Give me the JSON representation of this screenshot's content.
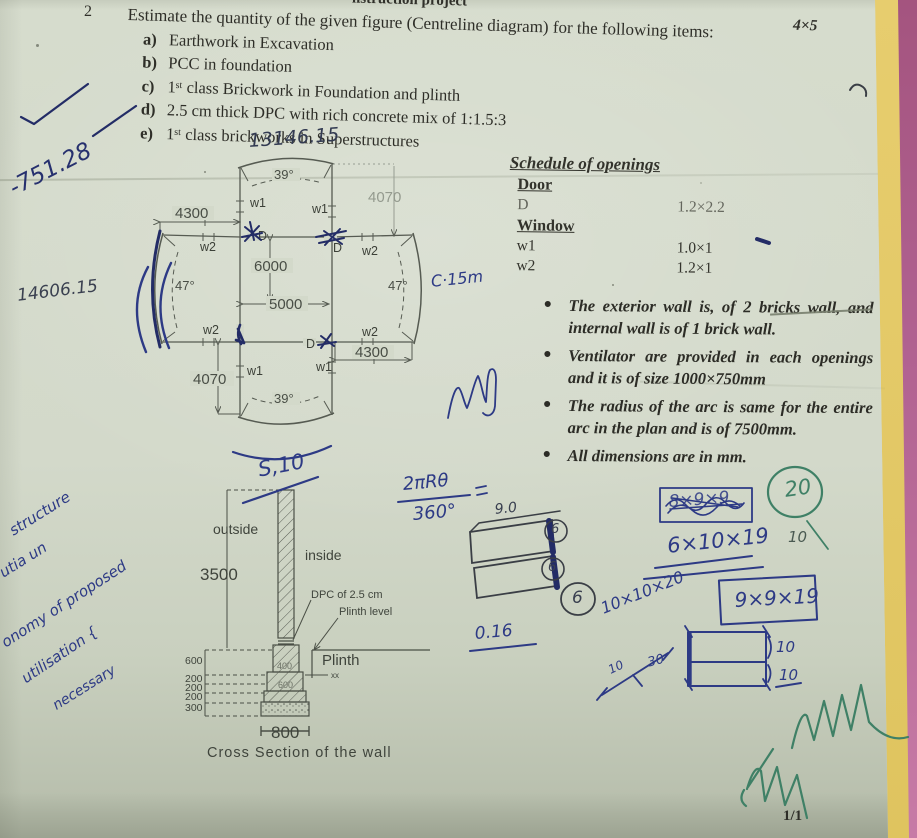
{
  "page": {
    "number_label": "2",
    "top_scrap": "nstruction project",
    "question": "Estimate the quantity of the given figure (Centreline diagram) for the following items:",
    "marks": "4×5",
    "items": [
      {
        "label": "a)",
        "text": "Earthwork in Excavation"
      },
      {
        "label": "b)",
        "text": "PCC in foundation"
      },
      {
        "label": "c)",
        "text": "1ˢᵗ class Brickwork in Foundation and plinth"
      },
      {
        "label": "d)",
        "text": "2.5 cm thick DPC with rich concrete mix of 1:1.5:3"
      },
      {
        "label": "e)",
        "text": "1ˢᵗ class brickworks in Superstructures"
      }
    ],
    "footer": "1/1"
  },
  "schedule": {
    "title": "Schedule of openings",
    "door_heading": "Door",
    "door_row": {
      "name": "D",
      "size": "1.2×2.2"
    },
    "window_heading": "Window",
    "window_rows": [
      {
        "name": "w1",
        "size": "1.0×1"
      },
      {
        "name": "w2",
        "size": "1.2×1"
      }
    ]
  },
  "notes": {
    "bullets": [
      "The exterior wall is, of 2 bricks wall, and internal wall is of 1 brick wall.",
      "Ventilator are provided in each openings and it is of size 1000×750mm",
      "The radius of the arc is same for the entire arc in the plan and is of 7500mm.",
      "All dimensions are in mm."
    ]
  },
  "plan": {
    "dims": {
      "top_left_width": "4300",
      "top_right_height": "4070",
      "inner_vertical": "6000",
      "inner_horizontal": "5000",
      "bottom_left_height": "4070",
      "bottom_right_width": "4300"
    },
    "angles": {
      "top": "39°",
      "bottom": "39°",
      "left": "47°",
      "right": "47°"
    },
    "openings": {
      "window1": "w1",
      "window2": "w2",
      "door": "D"
    }
  },
  "cross_section": {
    "outside": "outside",
    "inside": "inside",
    "wall_height": "3500",
    "dpc": "DPC of 2.5 cm",
    "plinth_level": "Plinth level",
    "plinth": "Plinth",
    "tick": "xx",
    "left_dims": [
      "600",
      "200",
      "200",
      "200",
      "300"
    ],
    "step_dims": [
      "400",
      "600"
    ],
    "footing_width": "800",
    "caption": "Cross Section of the wall"
  },
  "annotations": {
    "top_total": "13146.15",
    "left_total": "14606.15",
    "margin_calc": "-751.28",
    "c15": "C·15m",
    "s10": "S,10",
    "formula_num": "2πRθ",
    "formula_den": "360°",
    "sketch_top": "9.0",
    "circled_a": "6",
    "circled_b": "6",
    "circled_mid": "6",
    "value_016": "0.16",
    "boxed_scribble": "8×9×9",
    "calc1": "6×10×19",
    "calc1_side": "10",
    "calc2": "10×10×20",
    "calc3": "9×9×19",
    "diag_a": "10",
    "diag_b": "30",
    "rect_a": "10",
    "rect_b": "10",
    "marks_circled": "20",
    "marks_below": "10",
    "cursive": [
      "structure",
      "utia un",
      "onomy of proposed",
      "utilisation {",
      "necessary"
    ]
  }
}
